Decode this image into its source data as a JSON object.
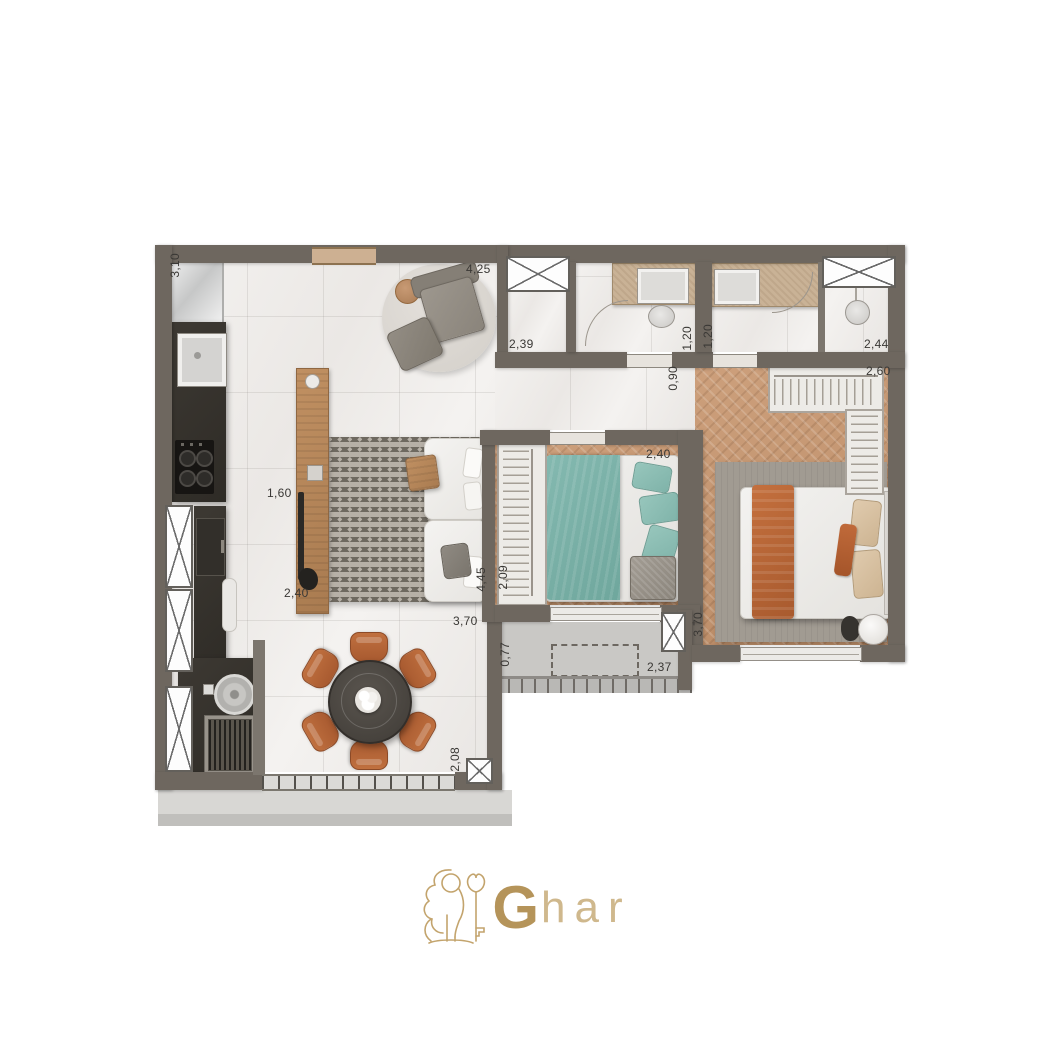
{
  "branding": {
    "logo_bold": "G",
    "logo_rest": "har",
    "logo_icon": "lion-with-key"
  },
  "colors": {
    "wall": "#6e675f",
    "wood_floor": "#c49672",
    "marble_floor": "#f1efed",
    "balcony_floor": "#c9c8c5",
    "teal_bed": "#7db4aa",
    "terracotta": "#b5653a",
    "counter_dark": "#35322c",
    "logo_gold": "#b5945a"
  },
  "dimension_labels": [
    {
      "id": "kitchen-top",
      "text": "3,10"
    },
    {
      "id": "living-top-width",
      "text": "4,25"
    },
    {
      "id": "shower-room",
      "text": "2,39"
    },
    {
      "id": "bath1-right",
      "text": "1,20"
    },
    {
      "id": "bath2-left",
      "text": "1,20"
    },
    {
      "id": "hall-passage",
      "text": "0,90"
    },
    {
      "id": "bath2-width",
      "text": "2,44"
    },
    {
      "id": "master-closet",
      "text": "2,60"
    },
    {
      "id": "bedroom2-width",
      "text": "2,40"
    },
    {
      "id": "kitchen-aisle",
      "text": "1,60"
    },
    {
      "id": "living-rug-width",
      "text": "2,40"
    },
    {
      "id": "living-length",
      "text": "4,45"
    },
    {
      "id": "bedroom2-length",
      "text": "2,09"
    },
    {
      "id": "living-bottom-width",
      "text": "3,70"
    },
    {
      "id": "balcony-depth",
      "text": "0,77"
    },
    {
      "id": "balcony-width",
      "text": "2,37"
    },
    {
      "id": "master-length",
      "text": "3,70"
    },
    {
      "id": "terrace-edge",
      "text": "2,08"
    }
  ]
}
